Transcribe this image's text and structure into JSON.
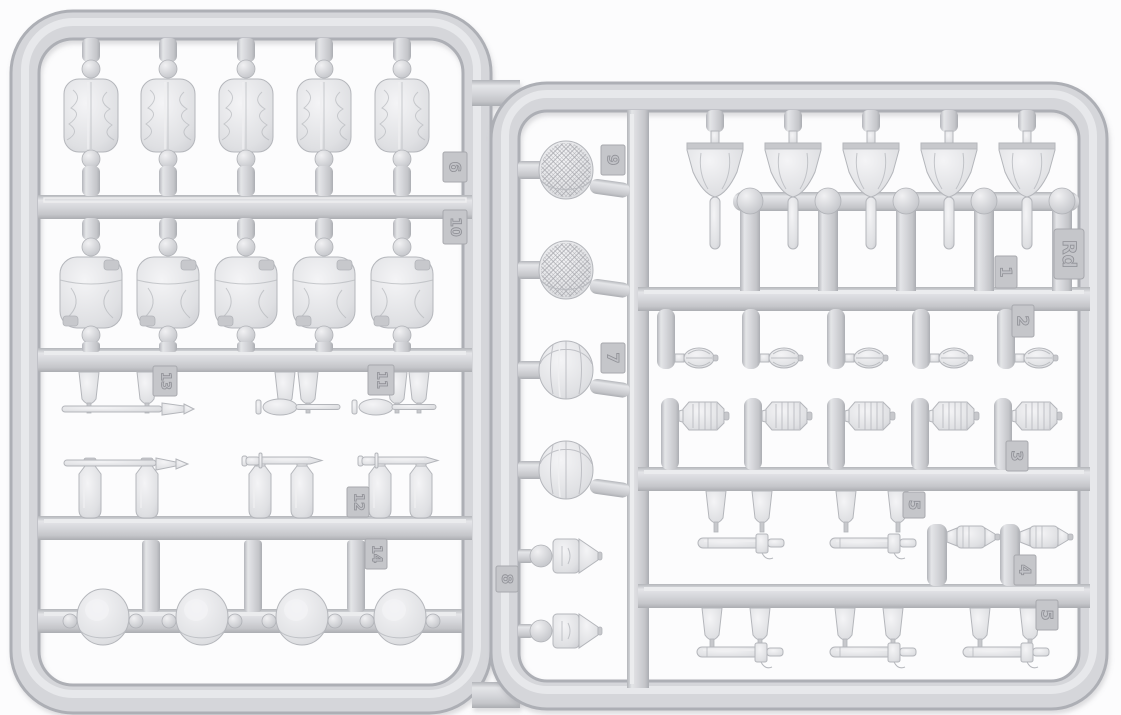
{
  "scene": {
    "subject": "Light grey injection-moulded plastic model kit sprue with military equipment parts on two joined runner frames",
    "sprue_code": "Rd",
    "background_color": "#fcfcfd",
    "plastic_color": "#d5d6da",
    "plastic_shadow_color": "#adafb5",
    "plastic_highlight_color": "#e9eaec",
    "tag_color": "#c5c6ca"
  },
  "tags": {
    "t6": {
      "label": "6"
    },
    "t10": {
      "label": "10"
    },
    "t13": {
      "label": "13"
    },
    "t11": {
      "label": "11"
    },
    "t12": {
      "label": "12"
    },
    "t14": {
      "label": "14"
    },
    "t9": {
      "label": "9"
    },
    "t7": {
      "label": "7"
    },
    "t8": {
      "label": "8"
    },
    "tRd": {
      "label": "Rd"
    },
    "t1": {
      "label": "1"
    },
    "t2": {
      "label": "2"
    },
    "t3": {
      "label": "3"
    },
    "t5a": {
      "label": "5"
    },
    "t4": {
      "label": "4"
    },
    "t5b": {
      "label": "5"
    }
  },
  "parts_inventory": [
    {
      "name": "rolled pack",
      "count": 5
    },
    {
      "name": "canvas bag",
      "count": 5
    },
    {
      "name": "entrenching tool set",
      "count": 3
    },
    {
      "name": "bayonet with flask posts",
      "count": 3
    },
    {
      "name": "dome helmet",
      "count": 4
    },
    {
      "name": "mesh-covered helmet",
      "count": 2
    },
    {
      "name": "cloth-covered helmet",
      "count": 2
    },
    {
      "name": "pointed shell",
      "count": 2
    },
    {
      "name": "spade",
      "count": 5
    },
    {
      "name": "egg grenade",
      "count": 5
    },
    {
      "name": "lantern",
      "count": 5
    },
    {
      "name": "sheathed bayonet",
      "count": 5
    },
    {
      "name": "cylindrical case",
      "count": 2
    }
  ]
}
